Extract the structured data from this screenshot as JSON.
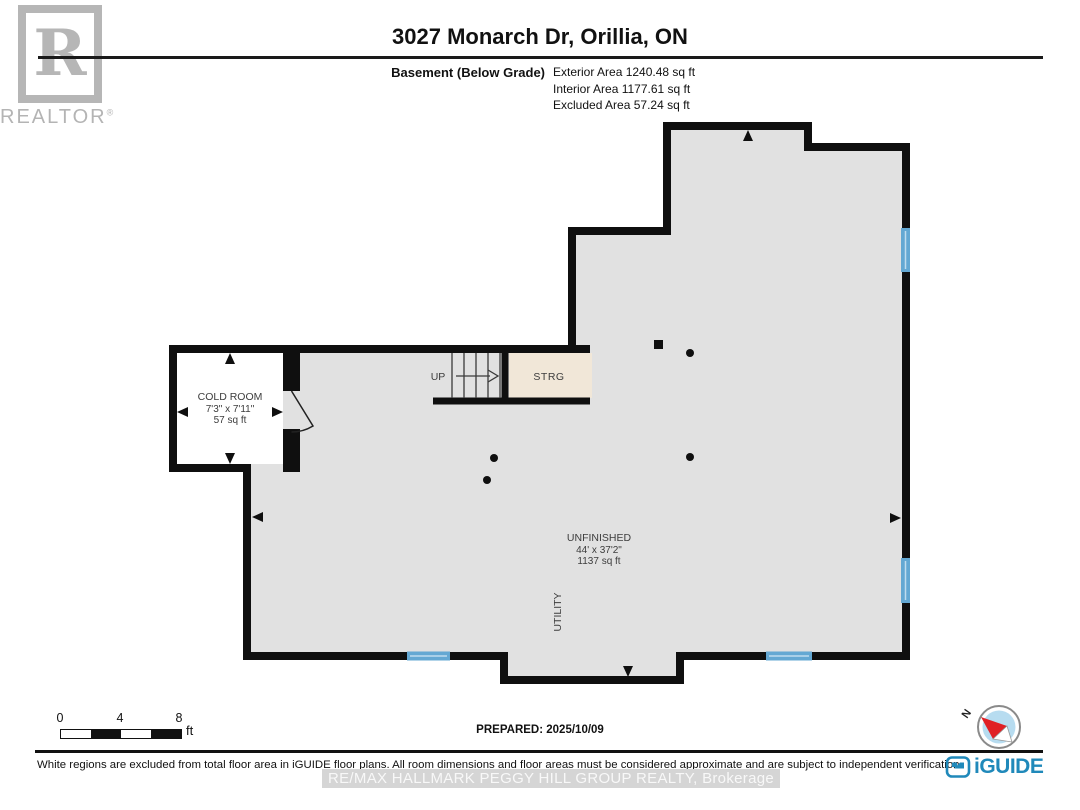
{
  "header": {
    "title": "3027 Monarch Dr, Orillia, ON",
    "floor_label": "Basement (Below Grade)",
    "exterior_area": "Exterior Area 1240.48 sq ft",
    "interior_area": "Interior Area 1177.61 sq ft",
    "excluded_area": "Excluded Area 57.24 sq ft"
  },
  "branding": {
    "realtor_letter": "R",
    "realtor_text": "REALTOR",
    "registered_mark": "®"
  },
  "floor_plan": {
    "rooms": {
      "cold_room": {
        "name": "COLD ROOM",
        "dimensions": "7'3\" x 7'11\"",
        "area": "57 sq ft"
      },
      "unfinished": {
        "name": "UNFINISHED",
        "dimensions": "44' x 37'2\"",
        "area": "1137 sq ft"
      },
      "utility": {
        "name": "UTILITY"
      },
      "storage": {
        "name": "STRG"
      },
      "stairs": {
        "label": "UP"
      }
    },
    "colors": {
      "floor": "#e1e1e1",
      "wall": "#0f0f0f",
      "window": "#64a8d3",
      "excluded_room": "#f1e7d8",
      "white_room": "#ffffff",
      "iguide_blue": "#2089ba",
      "compass_red": "#e02025"
    }
  },
  "scale_bar": {
    "ticks": [
      "0",
      "4",
      "8"
    ],
    "unit": "ft"
  },
  "prepared": {
    "label": "PREPARED:",
    "date": "2025/10/09"
  },
  "compass": {
    "north_label": "N"
  },
  "footer": {
    "disclaimer": "White regions are excluded from total floor area in iGUIDE floor plans. All room dimensions and floor areas must be considered approximate and are subject to independent verification.",
    "watermark": "RE/MAX HALLMARK PEGGY HILL GROUP REALTY, Brokerage",
    "iguide_logo_text": "iGUIDE"
  }
}
